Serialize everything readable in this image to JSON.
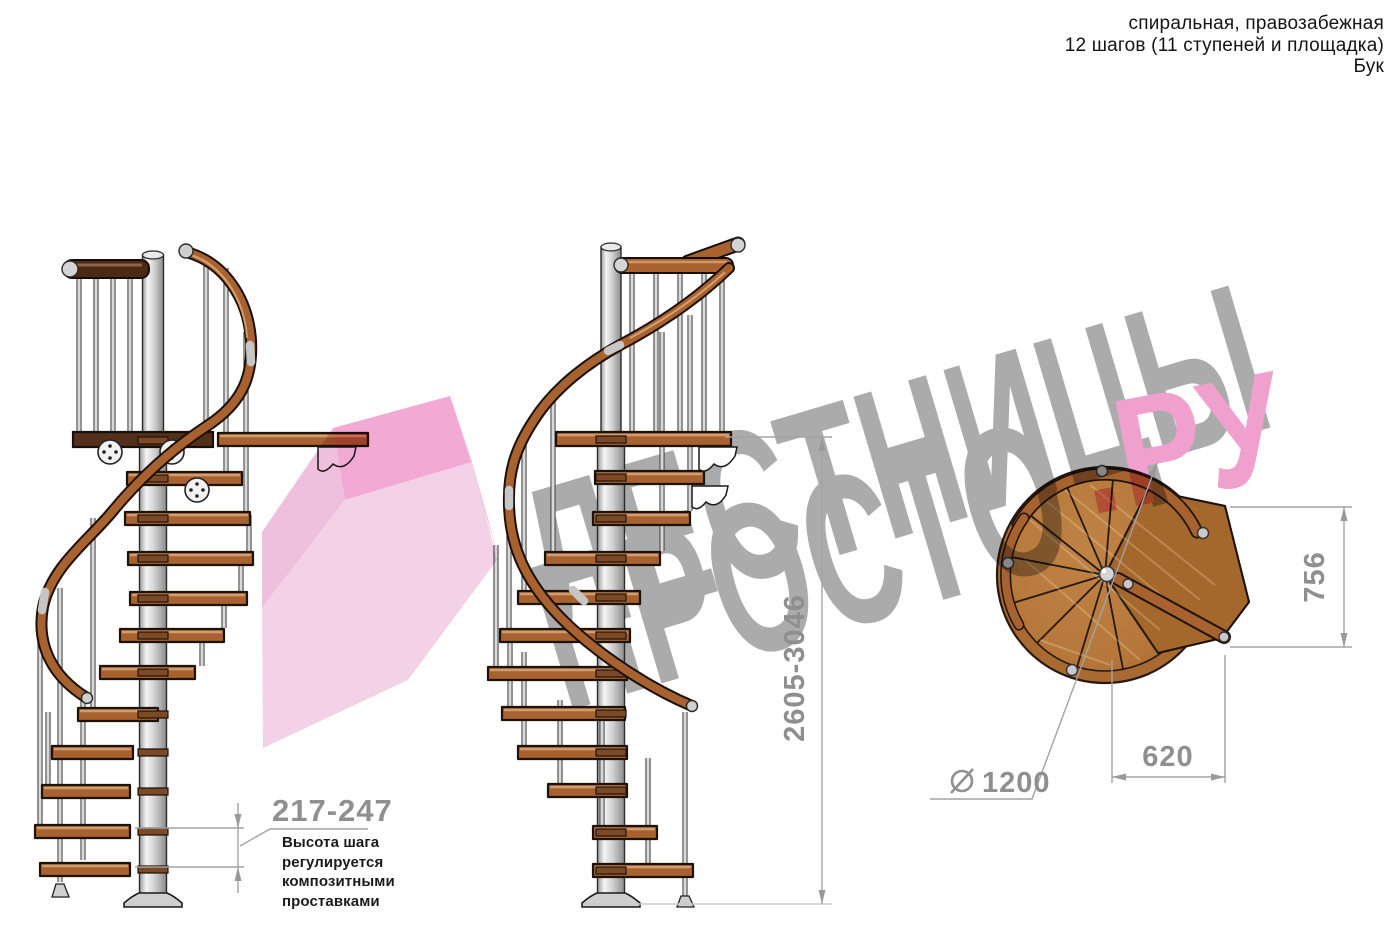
{
  "header": {
    "line1": "спиральная, правозабежная",
    "line2": "12 шагов (11 ступеней и площадка)",
    "line3": "Бук"
  },
  "watermark": {
    "word1": "ЛЕСТНИЦЫ",
    "word2": "ПРОСТО",
    "word2_suffix": ".РУ"
  },
  "dimensions": {
    "total_height": "2605-3046",
    "step_height": "217-247",
    "platform_depth": "756",
    "platform_width": "620",
    "diameter_value": "1200",
    "step_note_line1": "Высота шага",
    "step_note_line2": "регулируется",
    "step_note_line3": "композитными",
    "step_note_line4": "проставками"
  },
  "colors": {
    "wood": "#a8622f",
    "dark_wood": "#53301b",
    "metal": "#d6d6d6",
    "watermark_gray": "#ababab",
    "accent_pink": "#f2a3cf",
    "dimension_gray": "#8f8f8f"
  }
}
